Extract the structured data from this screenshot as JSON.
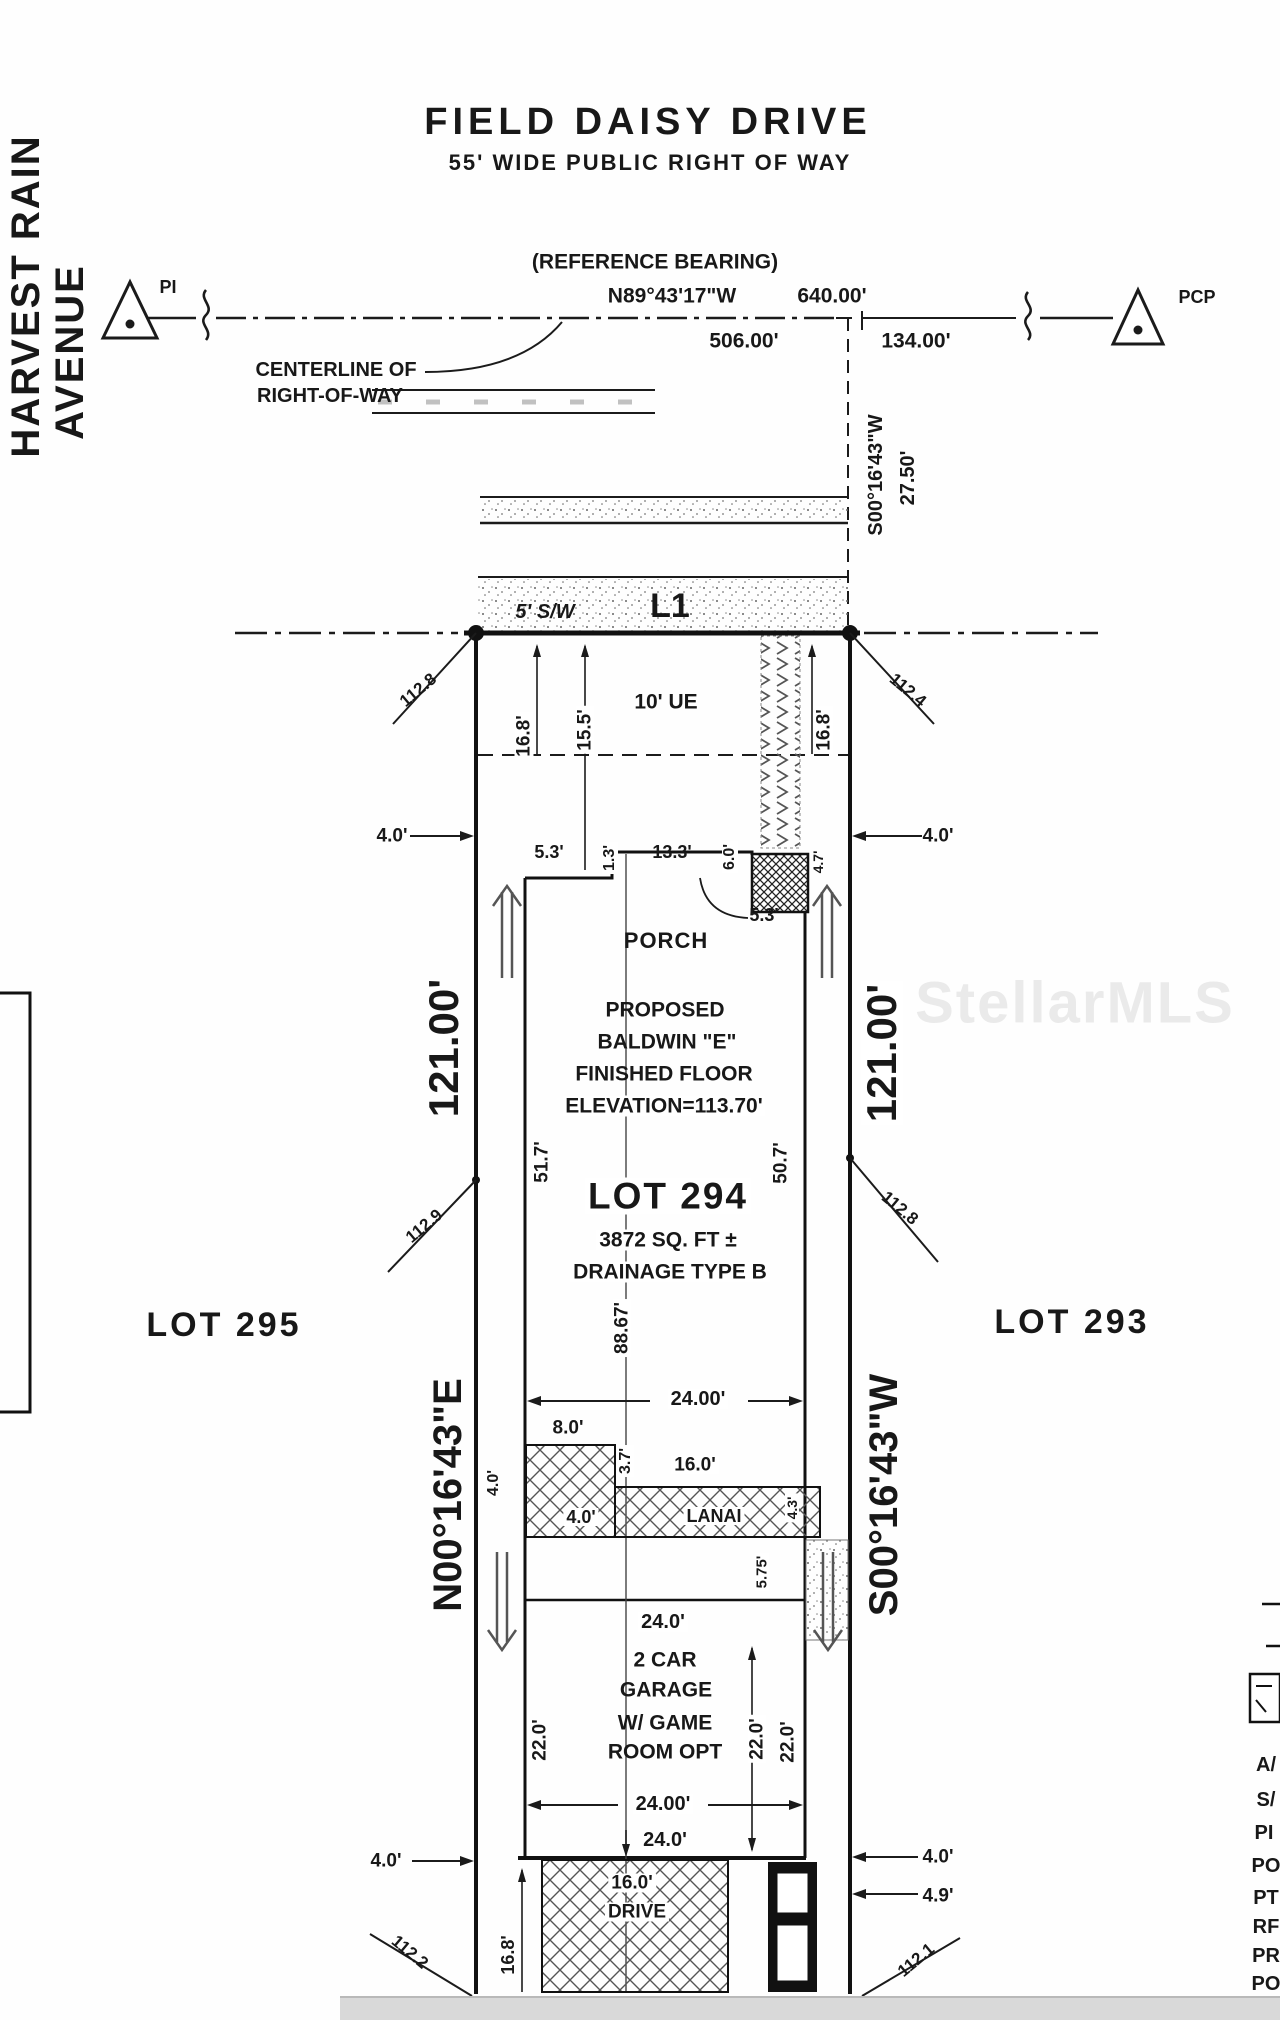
{
  "street": {
    "name": "FIELD DAISY DRIVE",
    "row": "55' WIDE PUBLIC RIGHT OF WAY",
    "side_street_1": "HARVEST RAIN",
    "side_street_2": "AVENUE",
    "ref_label": "(REFERENCE BEARING)",
    "ref_bearing": "N89°43'17\"W",
    "ref_dist": "640.00'",
    "dist_506": "506.00'",
    "dist_134": "134.00'",
    "centerline_1": "CENTERLINE OF",
    "centerline_2": "RIGHT-OF-WAY",
    "pi": "PI",
    "pcp": "PCP",
    "offset_bearing": "S00°16'43\"W",
    "offset_dist": "27.50'",
    "sidewalk": "5' S/W",
    "line_l1": "L1"
  },
  "lot": {
    "ue": "10' UE",
    "d168l": "16.8'",
    "d155": "15.5'",
    "d168r": "16.8'",
    "d40tl": "4.0'",
    "d40tr": "4.0'",
    "number": "LOT 294",
    "area": "3872 SQ. FT ±",
    "drainage": "DRAINAGE TYPE B",
    "depth": "88.67'",
    "left_dist": "121.00'",
    "left_bearing": "N00°16'43\"E",
    "right_dist": "121.00'",
    "right_bearing": "S00°16'43\"W",
    "lot_left": "LOT 295",
    "lot_right": "LOT 293"
  },
  "house": {
    "d53a": "5.3'",
    "d13": "1.3'",
    "d133": "13.3'",
    "d60": "6.0'",
    "d47": "4.7'",
    "d53b": "5.3'",
    "porch": "PORCH",
    "l1": "PROPOSED",
    "l2": "BALDWIN \"E\"",
    "l3": "FINISHED FLOOR",
    "l4": "ELEVATION=113.70'",
    "d517": "51.7'",
    "d507": "50.7'"
  },
  "lanai": {
    "d2400": "24.00'",
    "d80": "8.0'",
    "d37": "3.7'",
    "d160": "16.0'",
    "d40rot": "4.0'",
    "d40in": "4.0'",
    "label": "LANAI",
    "d43": "4.3'",
    "d575": "5.75'"
  },
  "garage": {
    "d240top": "24.0'",
    "l1": "2 CAR",
    "l2": "GARAGE",
    "l3": "W/ GAME",
    "l4": "ROOM OPT",
    "d220a": "22.0'",
    "d220b": "22.0'",
    "d220c": "22.0'",
    "d2400": "24.00'",
    "d240bot": "24.0'"
  },
  "drive": {
    "d160": "16.0'",
    "label": "DRIVE",
    "d168": "16.8'",
    "d40l": "4.0'",
    "d40r": "4.0'",
    "d49": "4.9'"
  },
  "spots": {
    "tl": "112.8",
    "tr": "112.4",
    "ml": "112.9",
    "mr": "112.8",
    "bl": "112.2",
    "br": "112.1"
  },
  "legend": {
    "items": [
      "A/",
      "S/",
      "PI",
      "PO",
      "PT",
      "RF",
      "PR",
      "PO"
    ]
  },
  "watermark": "StellarMLS"
}
